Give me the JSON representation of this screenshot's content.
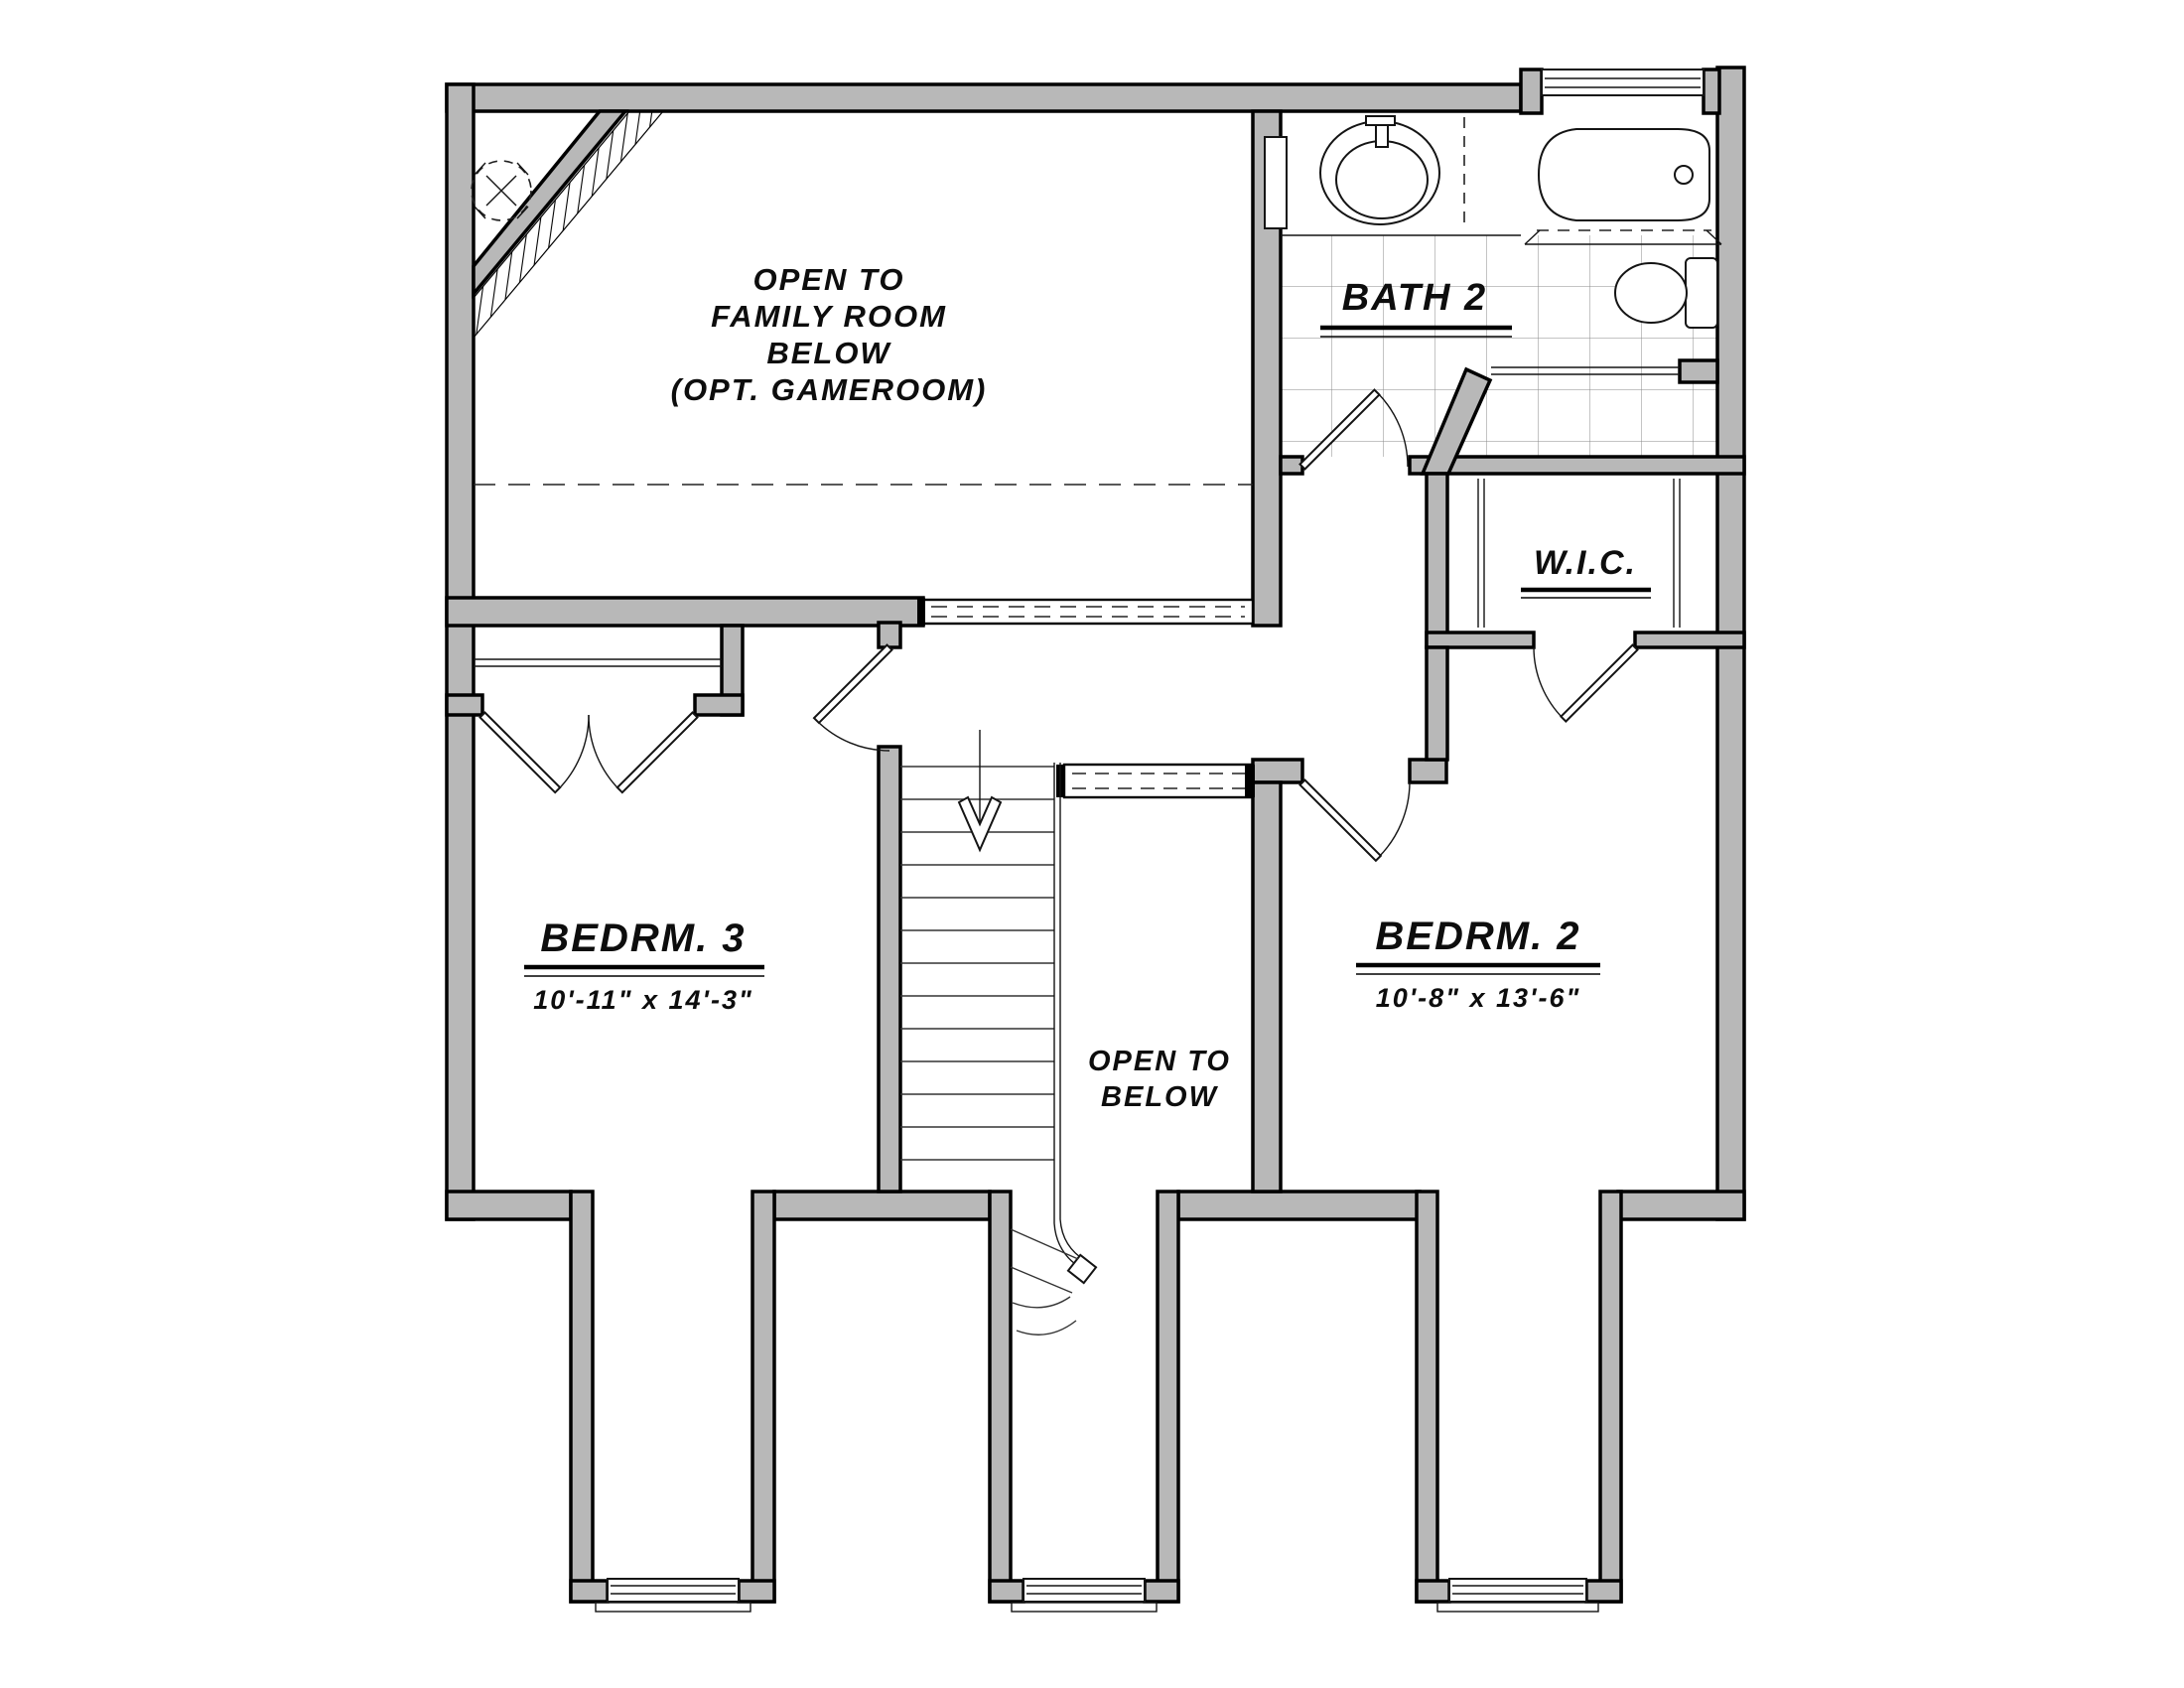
{
  "rooms": {
    "family_room_open": {
      "lines": [
        "OPEN TO",
        "FAMILY ROOM",
        "BELOW",
        "(OPT. GAMEROOM)"
      ]
    },
    "bath2": {
      "label": "BATH 2"
    },
    "wic": {
      "label": "W.I.C."
    },
    "bedroom3": {
      "label": "BEDRM. 3",
      "dims": "10'-11\" x 14'-3\""
    },
    "bedroom2": {
      "label": "BEDRM. 2",
      "dims": "10'-8\" x 13'-6\""
    },
    "stairwell": {
      "lines": [
        "OPEN TO",
        "BELOW"
      ]
    }
  },
  "colors": {
    "wall_fill": "#b8b8b8",
    "line_color": "#000000",
    "background": "#ffffff"
  }
}
